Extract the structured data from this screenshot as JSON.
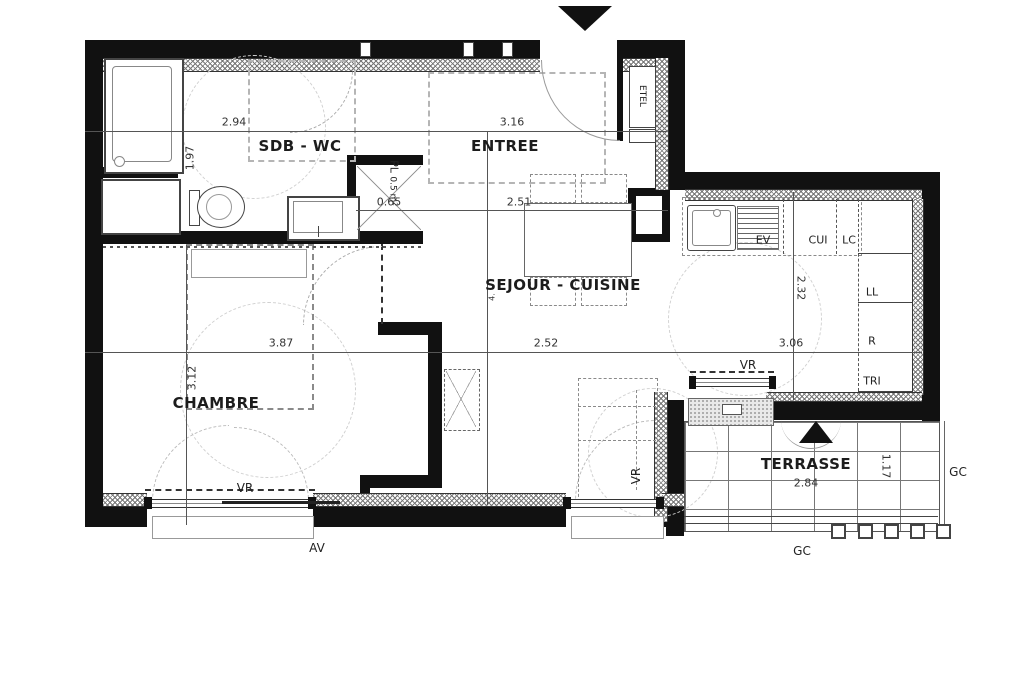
{
  "plan": {
    "type": "apartment-floor-plan",
    "rooms": {
      "sdb": "SDB - WC",
      "entree": "ENTREE",
      "sejour": "SEJOUR - CUISINE",
      "chambre": "CHAMBRE",
      "terrasse": "TERRASSE"
    },
    "dimensions": {
      "sdb_width": "2.94",
      "sdb_depth": "1.97",
      "entree_width": "3.16",
      "closet_width": "0.65",
      "sejour_top_width": "2.51",
      "sejour_mid_width": "2.52",
      "sejour_right_width": "3.06",
      "sejour_height": "2.32",
      "chambre_width": "3.87",
      "chambre_height": "3.12",
      "terrasse_width": "2.84",
      "terrasse_depth": "1.17",
      "sejour_partial_vertical": "4."
    },
    "annotations": {
      "closet": "PL",
      "closet_area": "0.5 m²",
      "etel": "ETEL",
      "sink": "EV",
      "cooking": "CUI",
      "lc": "LC",
      "washer": "LL",
      "fridge": "R",
      "waste": "TRI",
      "shutter": "VR",
      "sill": "AV",
      "railing": "GC"
    },
    "colors": {
      "wall": "#111111",
      "background": "#ffffff",
      "dimension_text": "#333333"
    }
  }
}
